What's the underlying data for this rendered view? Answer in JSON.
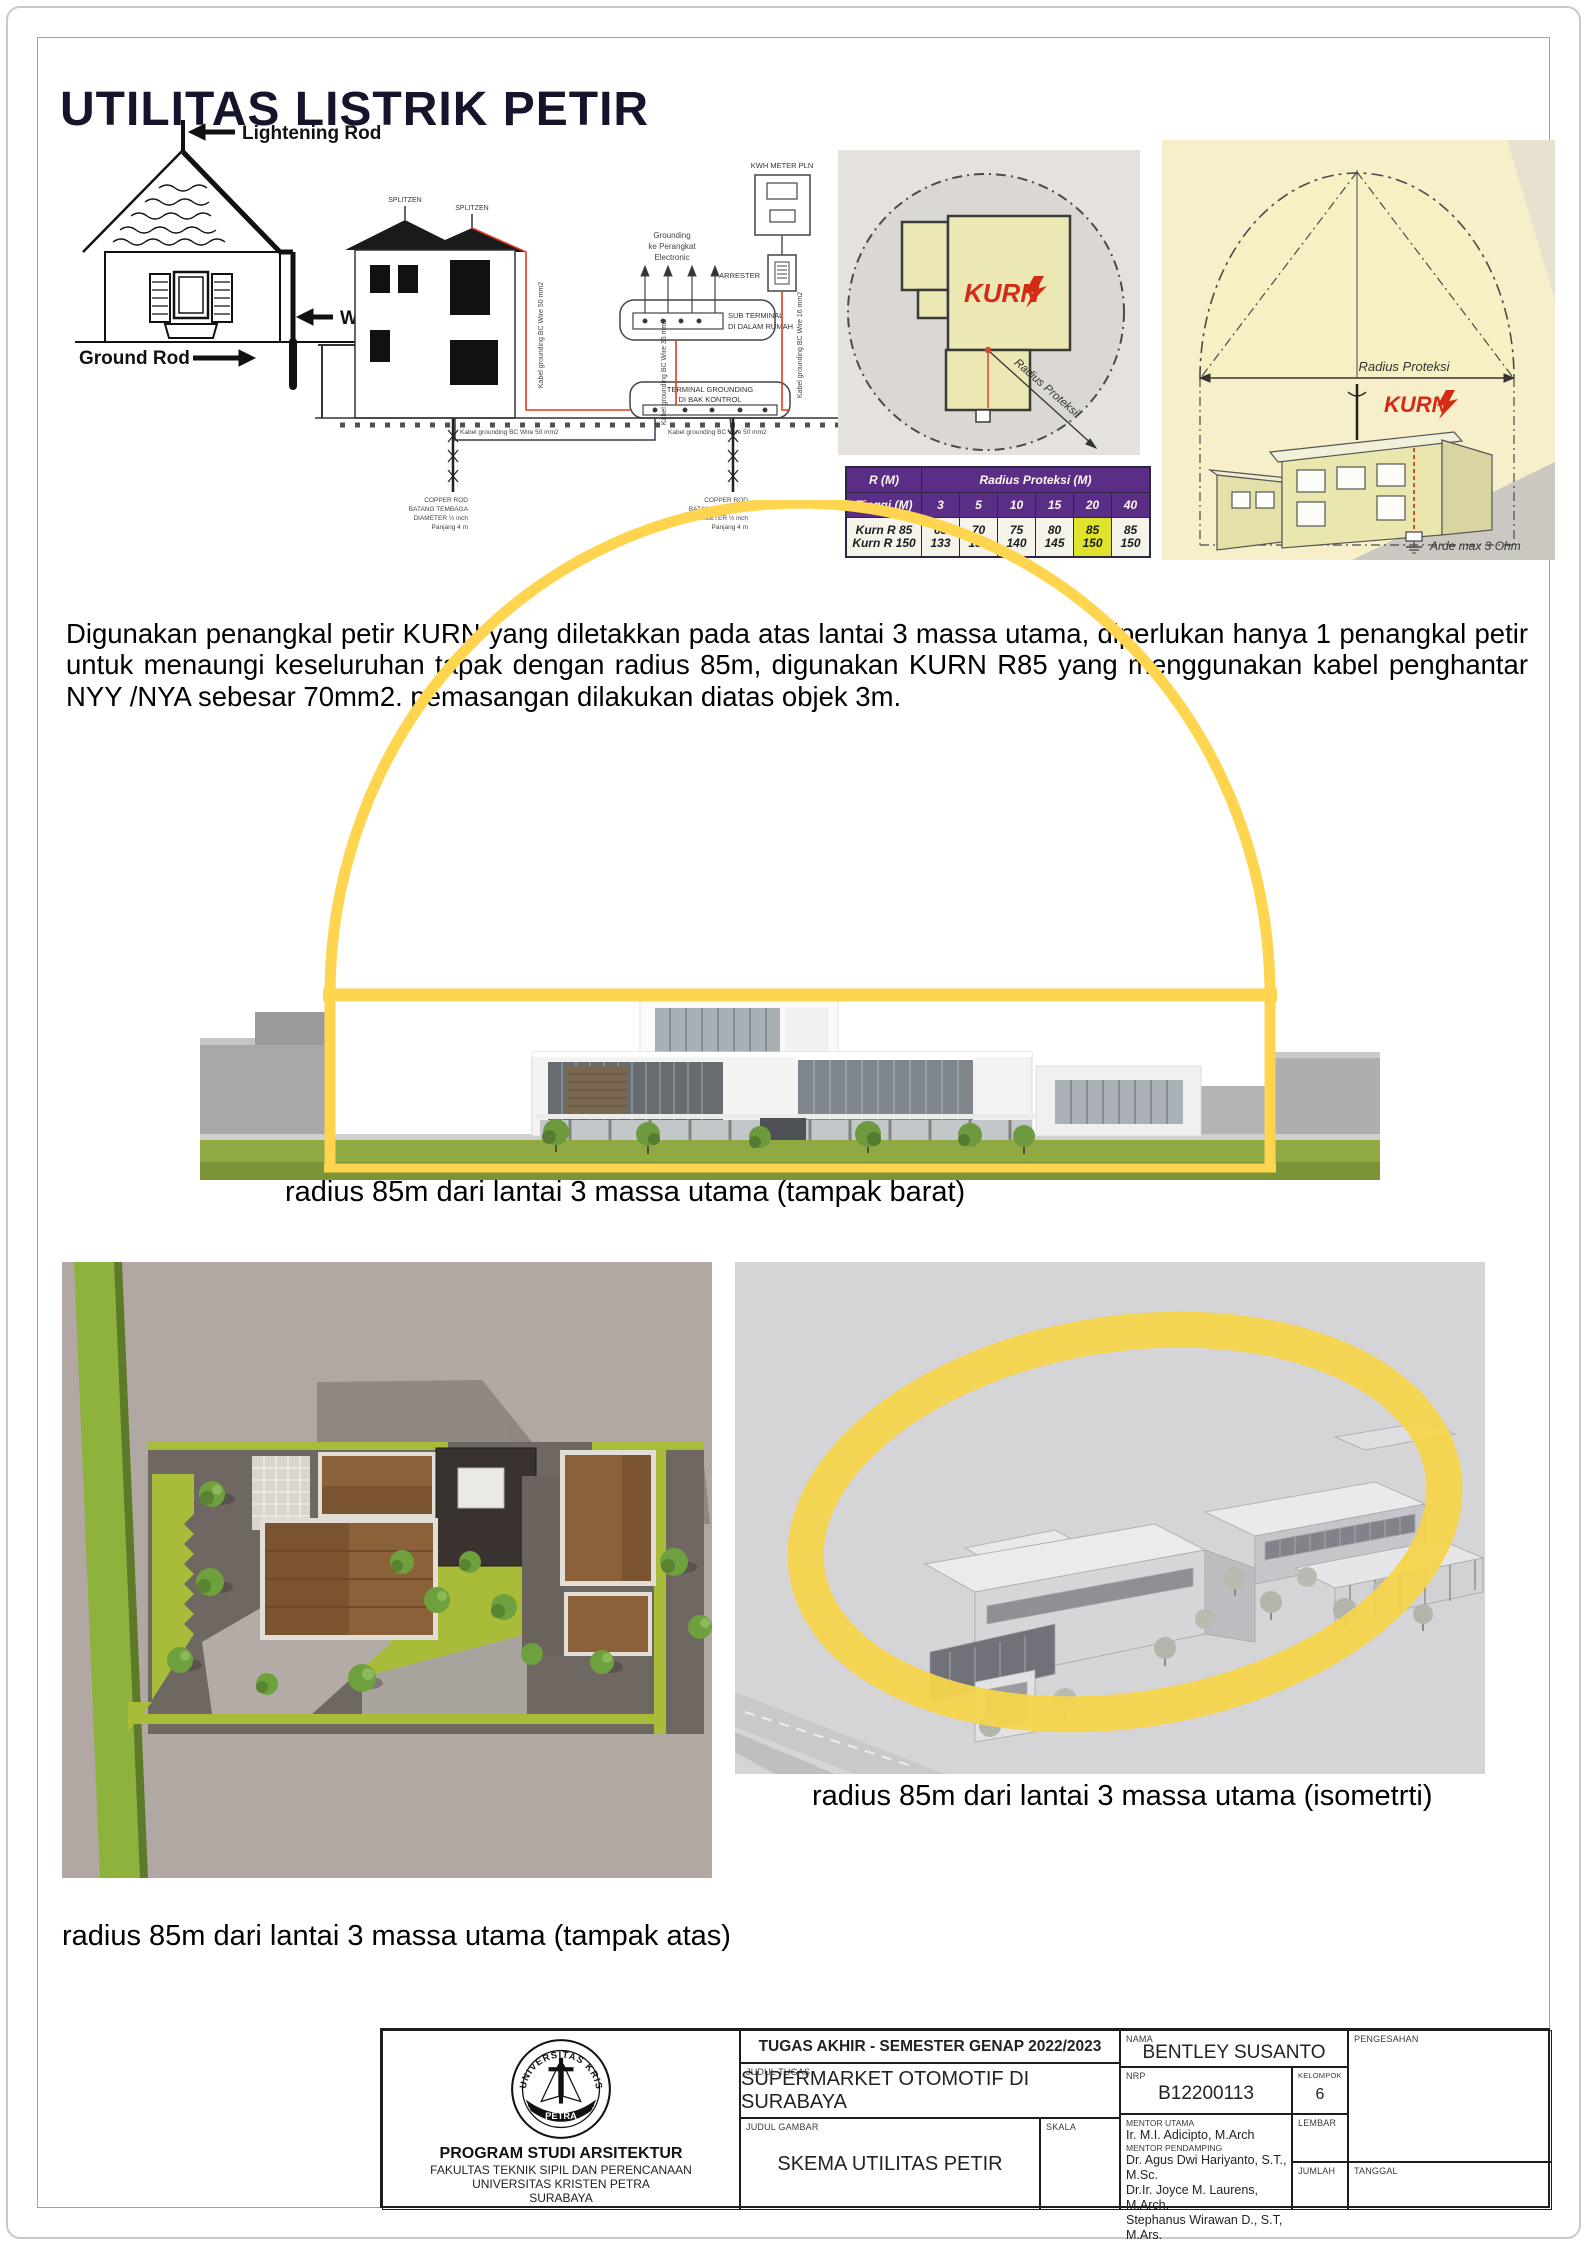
{
  "page": {
    "title": "UTILITAS LISTRIK PETIR"
  },
  "colors": {
    "arc_yellow": "#FFD54F",
    "ellipse_yellow": "#F6D44C",
    "table_header_purple": "#5A2D87",
    "table_highlight_yellow": "#DFE32B",
    "kurn_red": "#D42B17",
    "title_color": "#14142B"
  },
  "diagram_rod": {
    "rod_label": "Lightening Rod",
    "wire_label": "Wire",
    "ground_label": "Ground Rod"
  },
  "diagram_grounding": {
    "splitzen_left": "SPLITZEN",
    "splitzen_right": "SPLITZEN",
    "kwh_label": "KWH METER PLN",
    "arrester_label": "ARRESTER",
    "grounding_electronic_1": "Grounding",
    "grounding_electronic_2": "ke Perangkat",
    "grounding_electronic_3": "Electronic",
    "sub_terminal_1": "SUB TERMINAL",
    "sub_terminal_2": "DI DALAM RUMAH",
    "terminal_1": "TERMINAL GROUNDING",
    "terminal_2": "DI BAK KONTROL",
    "cable_house": "Kabel grounding BC Wire 50 mm2",
    "cable_sub": "Kabel grounding BC Wire 35 mm2",
    "cable_arrester": "Kabel grounding BC Wire 16 mm2",
    "cable_rod_left": "Kabel grounding BC Wire 50 mm2",
    "cable_rod_right": "Kabel grounding BC Wire 50 mm2",
    "copper_rod_lines": [
      "COPPER ROD",
      "BATANG TEMBAGA",
      "DIAMETER ½ inch",
      "Panjang 4 m"
    ]
  },
  "diagram_plan": {
    "brand": "KURN",
    "radius_label": "Radius Proteksi"
  },
  "protection_table": {
    "r_header": "R (M)",
    "radius_header": "Radius Proteksi (M)",
    "height_header": "Tinggi (M)",
    "heights": [
      "3",
      "5",
      "10",
      "15",
      "20",
      "40"
    ],
    "model_a": "Kurn R 85",
    "model_b": "Kurn R 150",
    "values_a": [
      "68",
      "70",
      "75",
      "80",
      "85",
      "85"
    ],
    "values_b": [
      "133",
      "135",
      "140",
      "145",
      "150",
      "150"
    ],
    "highlight_column_index": 4
  },
  "diagram_side": {
    "radius_label": "Radius Proteksi",
    "brand": "KURN",
    "arde_label": "Arde max 3 Ohm"
  },
  "paragraph": "Digunakan penangkal petir KURN yang diletakkan pada atas lantai 3 massa utama, diperlukan hanya 1 penangkal petir untuk menaungi keseluruhan tapak dengan radius 85m, digunakan KURN R85 yang menggunakan kabel penghantar NYY /NYA sebesar 70mm2. pemasangan dilakukan diatas objek 3m.",
  "captions": {
    "west": "radius 85m dari lantai 3 massa utama (tampak barat)",
    "isometric": "radius 85m dari lantai 3 massa utama (isometrti)",
    "top": "radius 85m dari lantai 3 massa utama (tampak atas)"
  },
  "titleblock": {
    "header": "TUGAS AKHIR - SEMESTER GENAP 2022/2023",
    "judul_tugas_label": "JUDUL TUGAS",
    "judul_tugas": "SUPERMARKET OTOMOTIF DI SURABAYA",
    "judul_gambar_label": "JUDUL GAMBAR",
    "judul_gambar": "SKEMA UTILITAS PETIR",
    "skala_label": "SKALA",
    "nama_label": "NAMA",
    "nama": "BENTLEY SUSANTO",
    "nrp_label": "NRP",
    "nrp": "B12200113",
    "kelompok_label": "KELOMPOK",
    "kelompok": "6",
    "mentor_utama_label": "MENTOR UTAMA",
    "mentor_utama": "Ir. M.I. Adicipto, M.Arch",
    "mentor_pendamping_label": "MENTOR PENDAMPING",
    "mentor_pendamping": [
      "Dr. Agus Dwi Hariyanto, S.T., M.Sc.",
      "Dr.Ir. Joyce M. Laurens, M.Arch.",
      "Stephanus Wirawan D., S.T, M.Ars."
    ],
    "pengesahan_label": "PENGESAHAN",
    "lembar_label": "LEMBAR",
    "jumlah_label": "JUMLAH",
    "tanggal_label": "TANGGAL",
    "prodi": "PROGRAM STUDI ARSITEKTUR",
    "fakultas": "FAKULTAS TEKNIK SIPIL DAN PERENCANAAN",
    "universitas": "UNIVERSITAS KRISTEN PETRA",
    "kota": "SURABAYA",
    "logo_top": "UNIVERSITAS KRISTEN",
    "logo_bottom": "PETRA"
  }
}
